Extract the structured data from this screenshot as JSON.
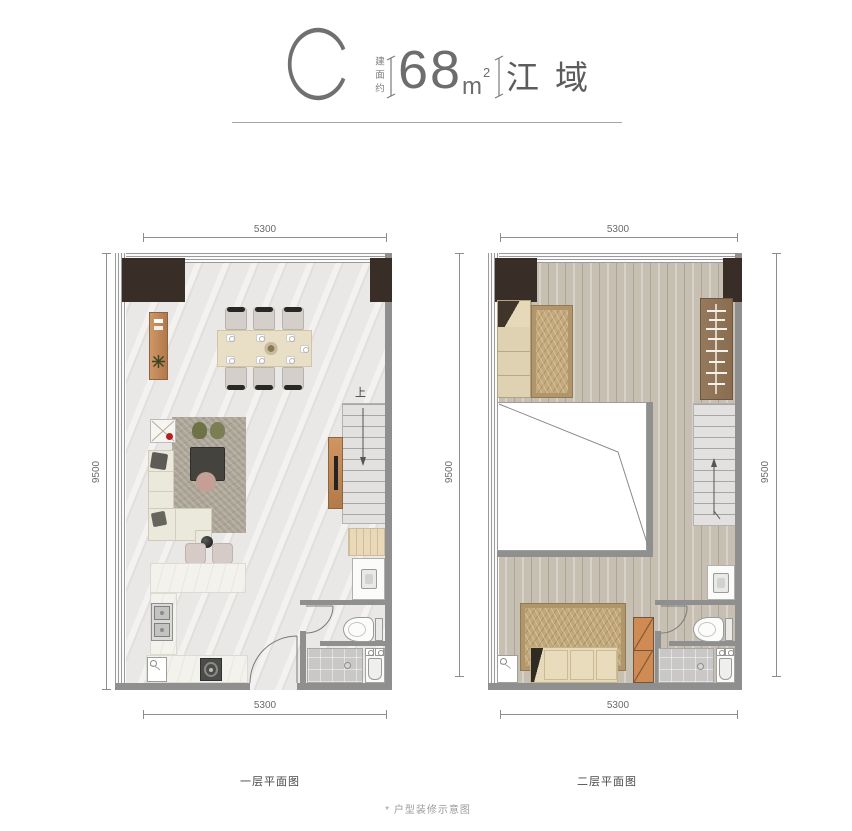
{
  "header": {
    "unit_type": "C",
    "area_prefix": "建面约",
    "area_value": "68",
    "area_unit": "m",
    "area_exponent": "2",
    "project_name": "江域"
  },
  "floor1": {
    "caption": "一层平面图",
    "dim_top": "5300",
    "dim_bottom": "5300",
    "dim_left": "9500",
    "stairs_direction": "上"
  },
  "floor2": {
    "caption": "二层平面图",
    "dim_top": "5300",
    "dim_bottom": "5300",
    "dim_left": "9500",
    "dim_right": "9500"
  },
  "footer": {
    "disclaimer": "* 户型装修示意图"
  },
  "colors": {
    "wall": "#8f8f8f",
    "dark_block": "#382e27",
    "wood_accent": "#c08a5c",
    "marble_floor": "#e9e8e6",
    "wood_floor": "#c6bfb2",
    "dim_text": "#6a6a6a"
  }
}
